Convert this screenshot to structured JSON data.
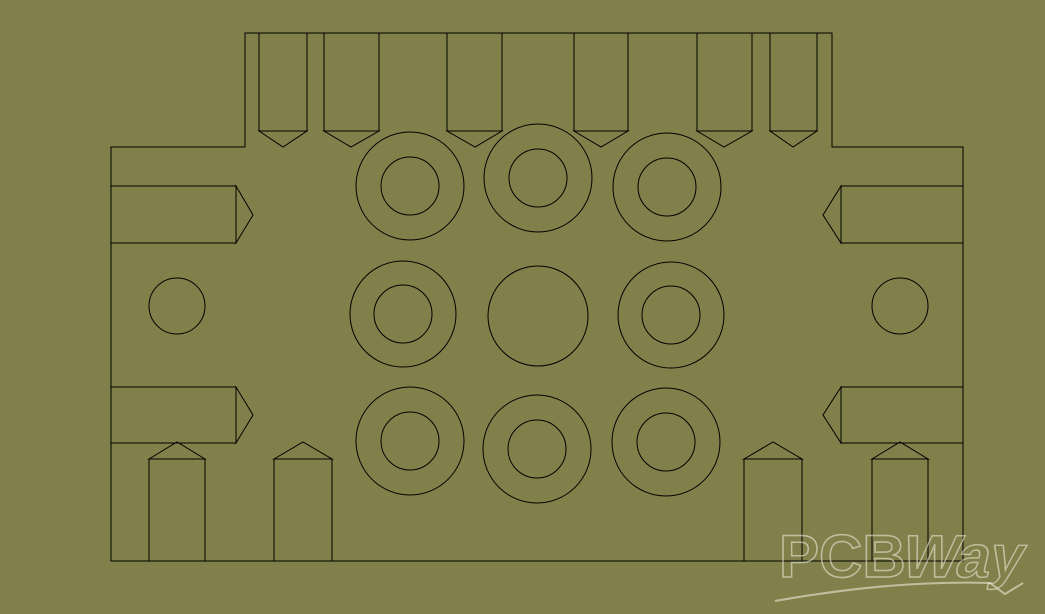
{
  "canvas": {
    "width": 1045,
    "height": 614,
    "background_color": "#81804A",
    "line_color": "#000000",
    "line_width": 1
  },
  "watermark": {
    "part1": "PCB",
    "part2": "Way",
    "color": "rgba(242,242,230,0.55)",
    "font_size": 60,
    "pcb_x": 779,
    "baseline_y": 577,
    "way_x": 899,
    "skew_deg": -13,
    "stroke_width": 1.5,
    "swoosh_path": "M775,601 C860,586 930,581 990,583 L1005,594 L1023,583",
    "swoosh_stroke_width": 2
  },
  "drawing": {
    "body_outline": [
      [
        111,
        147
      ],
      [
        245,
        147
      ],
      [
        245,
        33
      ],
      [
        832,
        33
      ],
      [
        832,
        147
      ],
      [
        963,
        147
      ],
      [
        963,
        561
      ],
      [
        111,
        561
      ]
    ],
    "top_pins": [
      {
        "x1": 259,
        "x2": 307,
        "y_top": 33,
        "y_shoulder": 131,
        "tip_x": 283,
        "tip_y": 147
      },
      {
        "x1": 324,
        "x2": 379,
        "y_top": 33,
        "y_shoulder": 131,
        "tip_x": 351,
        "tip_y": 147
      },
      {
        "x1": 447,
        "x2": 502,
        "y_top": 33,
        "y_shoulder": 131,
        "tip_x": 475,
        "tip_y": 147
      },
      {
        "x1": 574,
        "x2": 628,
        "y_top": 33,
        "y_shoulder": 131,
        "tip_x": 601,
        "tip_y": 147
      },
      {
        "x1": 697,
        "x2": 752,
        "y_top": 33,
        "y_shoulder": 131,
        "tip_x": 724,
        "tip_y": 147
      },
      {
        "x1": 770,
        "x2": 817,
        "y_top": 33,
        "y_shoulder": 131,
        "tip_x": 793,
        "tip_y": 147
      }
    ],
    "bottom_pins": [
      {
        "x1": 149,
        "x2": 205,
        "y_top": 459,
        "apex_x": 177,
        "apex_y": 442,
        "y_bottom": 561
      },
      {
        "x1": 274,
        "x2": 332,
        "y_top": 459,
        "apex_x": 303,
        "apex_y": 442,
        "y_bottom": 561
      },
      {
        "x1": 744,
        "x2": 802,
        "y_top": 459,
        "apex_x": 773,
        "apex_y": 442,
        "y_bottom": 561
      },
      {
        "x1": 872,
        "x2": 928,
        "y_top": 459,
        "apex_x": 900,
        "apex_y": 442,
        "y_bottom": 561
      }
    ],
    "left_arrows": [
      {
        "x1": 111,
        "x2": 236,
        "y1": 186,
        "y2": 243,
        "tip_x": 253,
        "tip_y": 215
      },
      {
        "x1": 111,
        "x2": 236,
        "y1": 387,
        "y2": 443,
        "tip_x": 253,
        "tip_y": 415
      }
    ],
    "right_arrows": [
      {
        "x1": 841,
        "x2": 963,
        "y1": 186,
        "y2": 243,
        "tip_x": 823,
        "tip_y": 215
      },
      {
        "x1": 841,
        "x2": 963,
        "y1": 387,
        "y2": 443,
        "tip_x": 823,
        "tip_y": 415
      }
    ],
    "donut_pads": [
      {
        "cx": 410,
        "cy": 186,
        "r_outer": 54,
        "r_inner": 29
      },
      {
        "cx": 538,
        "cy": 178,
        "r_outer": 54,
        "r_inner": 29
      },
      {
        "cx": 667,
        "cy": 187,
        "r_outer": 54,
        "r_inner": 29
      },
      {
        "cx": 403,
        "cy": 314,
        "r_outer": 53,
        "r_inner": 29
      },
      {
        "cx": 671,
        "cy": 315,
        "r_outer": 53,
        "r_inner": 29
      },
      {
        "cx": 410,
        "cy": 441,
        "r_outer": 54,
        "r_inner": 29
      },
      {
        "cx": 537,
        "cy": 449,
        "r_outer": 54,
        "r_inner": 29
      },
      {
        "cx": 666,
        "cy": 442,
        "r_outer": 54,
        "r_inner": 29
      }
    ],
    "center_circle": {
      "cx": 538,
      "cy": 316,
      "r": 50
    },
    "side_circles": [
      {
        "cx": 177,
        "cy": 306,
        "r": 28
      },
      {
        "cx": 900,
        "cy": 306,
        "r": 28
      }
    ]
  }
}
